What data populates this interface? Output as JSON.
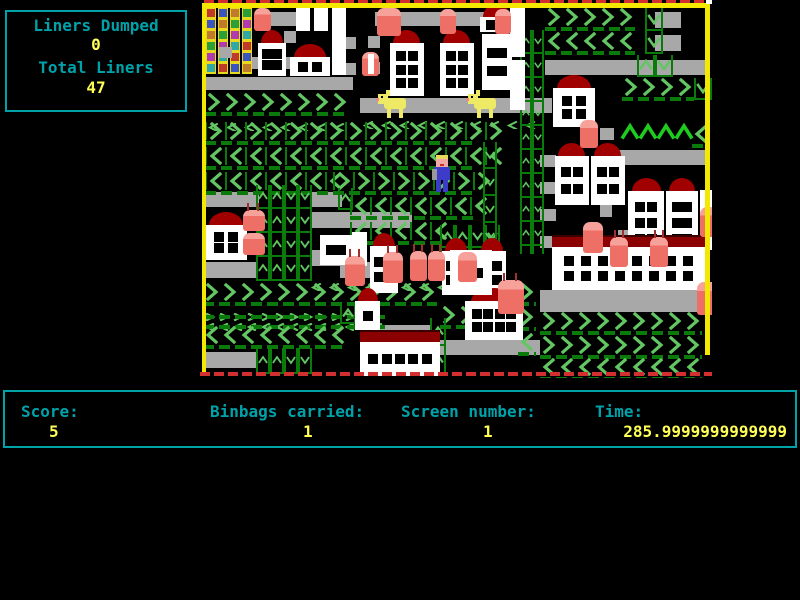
{
  "colors": {
    "bg": "#000000",
    "panel_border": "#00a2aa",
    "label_text": "#00a2aa",
    "value_text": "#ffff55",
    "game_border_yellow": "#f5e800",
    "red_dash": "#d23030",
    "conveyor_gray": "#a8a8a8",
    "chevron_light": "#63c663",
    "chevron_dark": "#0a7a0a",
    "chevron_bright": "#1ecb1e",
    "building_white": "#ffffff",
    "roof_red": "#a00000",
    "binbag_red": "#ee6f66",
    "binbag_highlight": "#f7a19b",
    "dog_yellow": "#eeea66",
    "player_blue": "#3c3cc8",
    "player_skin": "#f2a8a4",
    "player_hair": "#e8d95a",
    "flats_yellow": "#e8d820"
  },
  "hud": {
    "liners_dumped_label": "Liners Dumped",
    "liners_dumped_value": "0",
    "total_liners_label": "Total Liners",
    "total_liners_value": "47"
  },
  "status": {
    "score_label": "Score:",
    "score_value": "5",
    "binbags_label": "Binbags carried:",
    "binbags_value": "1",
    "screen_label": "Screen number:",
    "screen_value": "1",
    "time_label": "Time:",
    "time_value": "285.9999999999999"
  },
  "game": {
    "area": {
      "x": 200,
      "y": 0,
      "w": 512,
      "h": 378
    },
    "conveyors": [
      [
        3,
        77,
        150,
        13
      ],
      [
        70,
        12,
        28,
        14
      ],
      [
        175,
        12,
        128,
        14
      ],
      [
        160,
        98,
        192,
        15
      ],
      [
        345,
        60,
        160,
        15
      ],
      [
        3,
        192,
        56,
        15
      ],
      [
        112,
        192,
        30,
        15
      ],
      [
        110,
        212,
        102,
        16
      ],
      [
        110,
        250,
        38,
        16
      ],
      [
        243,
        258,
        18,
        13
      ],
      [
        3,
        262,
        54,
        16
      ],
      [
        140,
        262,
        62,
        16
      ],
      [
        3,
        352,
        54,
        16
      ],
      [
        170,
        325,
        62,
        15
      ],
      [
        240,
        340,
        100,
        15
      ],
      [
        340,
        290,
        158,
        22
      ],
      [
        410,
        150,
        98,
        15
      ],
      [
        50,
        57,
        10,
        12
      ],
      [
        84,
        31,
        12,
        12
      ],
      [
        84,
        57,
        12,
        12
      ],
      [
        146,
        37,
        10,
        12
      ],
      [
        146,
        63,
        10,
        12
      ],
      [
        168,
        36,
        12,
        12
      ],
      [
        168,
        62,
        12,
        12
      ],
      [
        455,
        12,
        26,
        16
      ],
      [
        455,
        35,
        26,
        16
      ],
      [
        340,
        155,
        16,
        12
      ],
      [
        340,
        182,
        16,
        12
      ],
      [
        340,
        209,
        16,
        12
      ],
      [
        340,
        236,
        16,
        12
      ],
      [
        400,
        128,
        14,
        12
      ],
      [
        400,
        205,
        12,
        12
      ],
      [
        418,
        230,
        14,
        12
      ]
    ],
    "chevron_rows": [
      {
        "d": "R",
        "x": 345,
        "y": 8,
        "n": 5,
        "v": "big"
      },
      {
        "d": "L",
        "x": 345,
        "y": 32,
        "n": 5,
        "v": "big"
      },
      {
        "d": "R",
        "x": 422,
        "y": 78,
        "n": 4,
        "v": "big"
      },
      {
        "d": "U",
        "x": 420,
        "y": 122,
        "n": 4,
        "v": "bright"
      },
      {
        "d": "L",
        "x": 492,
        "y": 125,
        "n": 1,
        "v": "big"
      },
      {
        "d": "R",
        "x": 5,
        "y": 93,
        "n": 8,
        "v": "big"
      },
      {
        "d": "hook",
        "x": 5,
        "y": 116,
        "n": 8,
        "v": "hook"
      },
      {
        "d": "hook",
        "x": 160,
        "y": 114,
        "n": 10,
        "v": "hook"
      },
      {
        "d": "R",
        "x": 5,
        "y": 122,
        "n": 15,
        "v": "big",
        "bars": 1
      },
      {
        "d": "L",
        "x": 5,
        "y": 147,
        "n": 15,
        "v": "big",
        "bars": 1
      },
      {
        "d": "L",
        "x": 5,
        "y": 172,
        "n": 7,
        "v": "big",
        "bars": 1
      },
      {
        "d": "R",
        "x": 133,
        "y": 172,
        "n": 8,
        "v": "big",
        "bars": 1
      },
      {
        "d": "L",
        "x": 150,
        "y": 197,
        "n": 7,
        "v": "big",
        "bars": 1
      },
      {
        "d": "L",
        "x": 150,
        "y": 222,
        "n": 5,
        "v": "big",
        "bars": 1
      },
      {
        "d": "R",
        "x": 3,
        "y": 283,
        "n": 13,
        "v": "big"
      },
      {
        "d": "R",
        "x": 318,
        "y": 283,
        "n": 1,
        "v": "big"
      },
      {
        "d": "R",
        "x": 3,
        "y": 306,
        "n": 13,
        "v": "mini"
      },
      {
        "d": "L",
        "x": 3,
        "y": 316,
        "n": 13,
        "v": "mini"
      },
      {
        "d": "R",
        "x": 240,
        "y": 306,
        "n": 3,
        "v": "big"
      },
      {
        "d": "R",
        "x": 318,
        "y": 308,
        "n": 1,
        "v": "big"
      },
      {
        "d": "L",
        "x": 3,
        "y": 326,
        "n": 8,
        "v": "big"
      },
      {
        "d": "L",
        "x": 318,
        "y": 333,
        "n": 1,
        "v": "big"
      },
      {
        "d": "R",
        "x": 340,
        "y": 312,
        "n": 9,
        "v": "big"
      },
      {
        "d": "R",
        "x": 340,
        "y": 336,
        "n": 9,
        "v": "big"
      },
      {
        "d": "L",
        "x": 340,
        "y": 358,
        "n": 9,
        "v": "big"
      },
      {
        "d": "hook",
        "x": 108,
        "y": 276,
        "n": 8,
        "v": "hook"
      }
    ],
    "vtracks": [
      {
        "x": 320,
        "y": 30,
        "cols": "ud",
        "h": 224,
        "cw": 12
      },
      {
        "x": 56,
        "y": 185,
        "cols": "uudd",
        "h": 96,
        "cw": 14
      },
      {
        "x": 56,
        "y": 348,
        "cols": "uudd",
        "h": 26,
        "cw": 14
      },
      {
        "x": 437,
        "y": 55,
        "cols": "ud",
        "h": 22,
        "cw": 18
      },
      {
        "x": 445,
        "y": 8,
        "cols": "d",
        "h": 46,
        "cw": 18
      },
      {
        "x": 494,
        "y": 78,
        "cols": "d",
        "h": 22,
        "cw": 18
      },
      {
        "x": 230,
        "y": 318,
        "cols": "u",
        "h": 56,
        "cw": 16
      },
      {
        "x": 240,
        "y": 225,
        "cols": "uu",
        "h": 46,
        "cw": 15
      },
      {
        "x": 270,
        "y": 225,
        "cols": "dd",
        "h": 46,
        "cw": 15
      },
      {
        "x": 140,
        "y": 303,
        "cols": "ud",
        "h": 21,
        "cw": 16
      },
      {
        "x": 138,
        "y": 188,
        "cols": "u",
        "h": 22,
        "cw": 15
      },
      {
        "x": 283,
        "y": 142,
        "cols": "d",
        "h": 110,
        "cw": 14
      }
    ],
    "buildings": [
      [
        58,
        30,
        28,
        46,
        "dome",
        2,
        2,
        0
      ],
      [
        90,
        44,
        40,
        32,
        "dome",
        2,
        1,
        0
      ],
      [
        96,
        5,
        14,
        26,
        "none",
        0,
        0,
        0
      ],
      [
        114,
        5,
        14,
        26,
        "none",
        0,
        0,
        0
      ],
      [
        132,
        5,
        14,
        26,
        "none",
        0,
        0,
        0
      ],
      [
        132,
        31,
        14,
        44,
        "none",
        0,
        0,
        0
      ],
      [
        190,
        30,
        34,
        66,
        "dome",
        2,
        3,
        0
      ],
      [
        240,
        30,
        34,
        66,
        "dome",
        2,
        3,
        0
      ],
      [
        280,
        4,
        34,
        28,
        "dome",
        2,
        1,
        1
      ],
      [
        282,
        34,
        30,
        56,
        "none",
        2,
        2,
        0
      ],
      [
        310,
        5,
        15,
        52,
        "none",
        0,
        0,
        0
      ],
      [
        310,
        60,
        15,
        50,
        "none",
        0,
        0,
        0
      ],
      [
        5,
        212,
        42,
        48,
        "dome",
        2,
        2,
        0
      ],
      [
        170,
        233,
        28,
        60,
        "dome",
        2,
        2,
        0
      ],
      [
        242,
        238,
        28,
        57,
        "dome",
        2,
        2,
        0
      ],
      [
        278,
        238,
        28,
        57,
        "dome",
        2,
        2,
        0
      ],
      [
        120,
        235,
        32,
        30,
        "none",
        2,
        1,
        0
      ],
      [
        152,
        232,
        15,
        34,
        "none",
        0,
        0,
        0
      ],
      [
        353,
        75,
        42,
        52,
        "dome",
        2,
        2,
        0
      ],
      [
        355,
        143,
        34,
        62,
        "dome",
        2,
        2,
        0
      ],
      [
        391,
        143,
        34,
        62,
        "dome",
        2,
        2,
        0
      ],
      [
        428,
        178,
        36,
        77,
        "dome",
        2,
        3,
        0
      ],
      [
        466,
        178,
        32,
        77,
        "dome",
        2,
        3,
        0
      ],
      [
        500,
        190,
        12,
        60,
        "none",
        0,
        0,
        0
      ],
      [
        160,
        330,
        80,
        46,
        "long",
        5,
        1,
        0
      ],
      [
        265,
        288,
        58,
        52,
        "dome",
        4,
        2,
        0
      ],
      [
        250,
        250,
        42,
        45,
        "none",
        2,
        1,
        0
      ],
      [
        352,
        235,
        153,
        55,
        "long",
        8,
        2,
        0
      ],
      [
        155,
        288,
        25,
        42,
        "dome",
        1,
        1,
        0
      ]
    ],
    "bins": [
      [
        54,
        8,
        17,
        23,
        0,
        0
      ],
      [
        177,
        8,
        24,
        28,
        0,
        0
      ],
      [
        240,
        9,
        16,
        25,
        0,
        0
      ],
      [
        295,
        9,
        16,
        25,
        0,
        0
      ],
      [
        162,
        52,
        17,
        24,
        0,
        1
      ],
      [
        43,
        210,
        22,
        21,
        1,
        0
      ],
      [
        43,
        233,
        22,
        22,
        0,
        0
      ],
      [
        145,
        256,
        20,
        30,
        1,
        0
      ],
      [
        183,
        252,
        20,
        31,
        1,
        0
      ],
      [
        210,
        251,
        17,
        30,
        1,
        0
      ],
      [
        228,
        251,
        17,
        30,
        1,
        0
      ],
      [
        258,
        252,
        19,
        30,
        0,
        0
      ],
      [
        298,
        280,
        26,
        34,
        1,
        0
      ],
      [
        380,
        120,
        18,
        28,
        0,
        0
      ],
      [
        383,
        222,
        20,
        31,
        0,
        0
      ],
      [
        410,
        237,
        18,
        30,
        1,
        0
      ],
      [
        450,
        237,
        18,
        30,
        1,
        0
      ],
      [
        497,
        282,
        22,
        33,
        0,
        0
      ],
      [
        500,
        207,
        17,
        30,
        0,
        0
      ]
    ],
    "flats": {
      "x": 6,
      "y": 7,
      "w": 48,
      "h": 67,
      "cols": 4,
      "notch": [
        19,
        47,
        13,
        11
      ],
      "window_colors": [
        "#c03a2b",
        "#3a55c0",
        "#c07a2b",
        "#2ba03a",
        "#b03ab0",
        "#30a8a8"
      ]
    },
    "dogs": [
      [
        178,
        92
      ],
      [
        268,
        92
      ]
    ],
    "player": {
      "x": 232,
      "y": 155
    }
  }
}
